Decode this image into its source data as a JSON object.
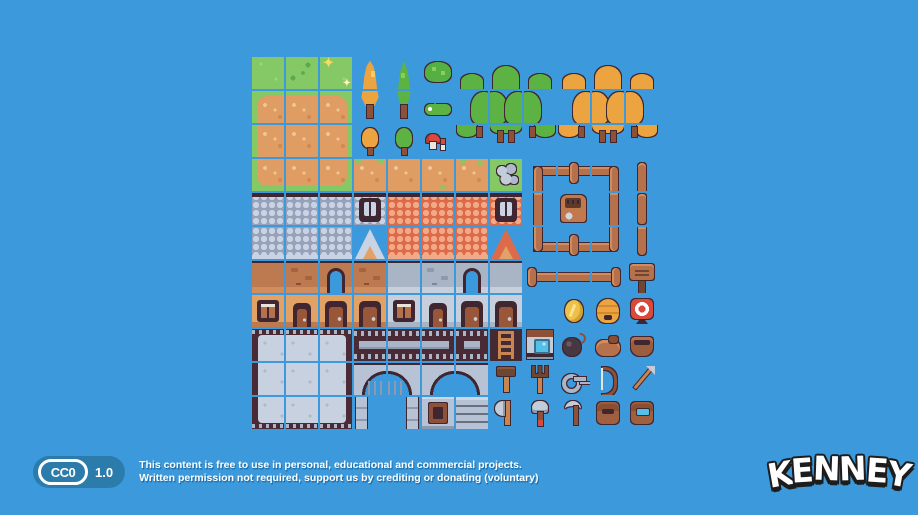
{
  "scene": {
    "background_color": "#3b99dc",
    "description": "Pixel-art RPG town tilesheet preview on blue background"
  },
  "tilesheet": {
    "columns": 12,
    "rows": 11,
    "tile_size": 32,
    "gap": 2,
    "origin_x": 252,
    "origin_y": 57,
    "grid": [
      [
        "grass",
        "grass_dark",
        "grass_sparkle",
        "tree_orange_top",
        "tree_pine_top",
        "bush",
        "fg_tl",
        "fg_tm",
        "fg_tr",
        "fo_tl",
        "fo_tm",
        "fo_tr"
      ],
      [
        "dirt_tl",
        "dirt_t",
        "dirt_tr",
        "tree_orange_bot",
        "tree_pine_bot",
        "caterpillar",
        "fg_ml",
        "fg_mm",
        "fg_mr",
        "fo_ml",
        "fo_mm",
        "fo_mr"
      ],
      [
        "dirt_l",
        "dirt_c",
        "dirt_r",
        "tree_orange_sm",
        "tree_pine_sm",
        "mushrooms",
        "fg_bl",
        "fg_bm",
        "fg_br",
        "fo_bl",
        "fo_bm",
        "fo_br"
      ],
      [
        "dirt_bl",
        "dirt_b",
        "dirt_br",
        "dirt_grass_top",
        "dirt_plain",
        "dirt_tuft",
        "dirt_tufts",
        "stones_grass",
        "fence_tl",
        "fence_tt",
        "fence_tr",
        "post_top"
      ],
      [
        "roof_gray",
        "roof_gray",
        "roof_gray",
        "roof_gray_win",
        "roof_red",
        "roof_red",
        "roof_red",
        "roof_red_win",
        "fence_vl",
        "shed",
        "fence_vr",
        "post_mid"
      ],
      [
        "roof_gray2",
        "roof_gray2",
        "roof_gray2",
        "roof_gray_peak",
        "roof_red2",
        "roof_red2",
        "roof_red2",
        "roof_red_peak",
        "fence_bl",
        "fence_bt",
        "fence_br",
        "post_bot"
      ],
      [
        "wall_tan",
        "wall_tan_br",
        "wall_tan_open",
        "wall_tan_br",
        "wall_gray",
        "wall_gray_br",
        "wall_gray_open",
        "wall_gray",
        "fence_end_l",
        "fence_rail",
        "fence_end_r",
        "sign"
      ],
      [
        "wall_tan_win",
        "wall_tan_door",
        "wall_tan_door2",
        "wall_tan_door2",
        "wall_gray_win",
        "wall_gray_door",
        "wall_gray_door2",
        "wall_gray_door2",
        "",
        "coin",
        "beehive",
        "target"
      ],
      [
        "plat_tl",
        "plat_t",
        "plat_tr",
        "bridge_l",
        "bridge_m",
        "bridge_r",
        "bridge_s",
        "ladder",
        "well",
        "bomb",
        "pouch",
        "basket"
      ],
      [
        "plat_l",
        "plat_c",
        "plat_r",
        "arch1_l",
        "arch1_r",
        "arch2_l",
        "arch2_r",
        "hammer",
        "pitchfork",
        "key",
        "bow",
        "arrow"
      ],
      [
        "plat_bl",
        "plat_b",
        "plat_br",
        "archleg_l",
        "archleg_r",
        "stone_win",
        "stone_brick",
        "axe",
        "sledge",
        "scythe",
        "satchel",
        "satchel_open"
      ]
    ],
    "legend": {
      "grass": "grass tile",
      "grass_dark": "grass with dark tufts",
      "grass_sparkle": "grass with sparkles",
      "tree_orange_top": "tall autumn tree (top)",
      "tree_orange_bot": "tall autumn tree (bottom with trunk)",
      "tree_pine_top": "tall pine tree (top)",
      "tree_pine_bot": "tall pine tree (bottom with trunk)",
      "bush": "round bush",
      "caterpillar": "green caterpillar",
      "mushrooms": "red mushrooms",
      "tree_orange_sm": "small autumn tree",
      "tree_pine_sm": "small pine tree",
      "fg_tl": "green forest top-left",
      "fg_tm": "green forest top-middle",
      "fg_tr": "green forest top-right",
      "fg_ml": "green forest middle-left",
      "fg_mm": "green forest middle",
      "fg_mr": "green forest middle-right",
      "fg_bl": "green forest bottom-left",
      "fg_bm": "green forest bottom trunks",
      "fg_br": "green forest bottom-right",
      "fo_tl": "autumn forest top-left",
      "fo_tm": "autumn forest top-middle",
      "fo_tr": "autumn forest top-right",
      "fo_ml": "autumn forest middle-left",
      "fo_mm": "autumn forest middle",
      "fo_mr": "autumn forest middle-right",
      "fo_bl": "autumn forest bottom-left",
      "fo_bm": "autumn forest bottom trunks",
      "fo_br": "autumn forest bottom-right",
      "dirt_tl": "dirt patch top-left",
      "dirt_t": "dirt patch top",
      "dirt_tr": "dirt patch top-right",
      "dirt_l": "dirt patch left",
      "dirt_c": "dirt patch center",
      "dirt_r": "dirt patch right",
      "dirt_bl": "dirt patch bottom-left",
      "dirt_b": "dirt patch bottom",
      "dirt_br": "dirt patch bottom-right",
      "dirt_grass_top": "dirt with grass edge",
      "dirt_plain": "plain dirt",
      "dirt_tuft": "dirt with tuft",
      "dirt_tufts": "dirt with tufts",
      "stones_grass": "pebbles on grass",
      "roof_gray": "gray shingle roof",
      "roof_gray2": "gray shingle roof eave",
      "roof_gray_win": "gray roof attic window",
      "roof_gray_peak": "gray roof gable peak",
      "roof_red": "red shingle roof",
      "roof_red2": "red shingle roof eave",
      "roof_red_win": "red roof attic window",
      "roof_red_peak": "red roof gable peak",
      "wall_tan": "tan wall",
      "wall_tan_br": "tan wall with bricks",
      "wall_tan_open": "tan wall doorway opening",
      "wall_gray": "gray wall",
      "wall_gray_br": "gray wall with bricks",
      "wall_gray_open": "gray wall doorway opening",
      "wall_tan_win": "tan facade window",
      "wall_tan_door": "tan facade small door",
      "wall_tan_door2": "tan facade large door",
      "wall_gray_win": "gray facade window",
      "wall_gray_door": "gray facade small door",
      "wall_gray_door2": "gray facade large door",
      "fence_tl": "fence corner top-left",
      "fence_tt": "fence top junction",
      "fence_tr": "fence corner top-right",
      "fence_vl": "fence vertical left",
      "fence_vr": "fence vertical right",
      "fence_bl": "fence corner bottom-left",
      "fence_bt": "fence bottom junction",
      "fence_br": "fence corner bottom-right",
      "fence_end_l": "fence end left",
      "fence_rail": "fence rail",
      "fence_end_r": "fence end right",
      "post_top": "wooden post top",
      "post_mid": "wooden post middle",
      "post_bot": "wooden post bottom",
      "sign": "wooden sign",
      "shed": "wooden shed with lock",
      "plat_tl": "stone platform top-left",
      "plat_t": "stone platform top",
      "plat_tr": "stone platform top-right",
      "plat_l": "stone platform left",
      "plat_c": "stone platform center",
      "plat_r": "stone platform right",
      "plat_bl": "stone platform bottom-left",
      "plat_b": "stone platform bottom",
      "plat_br": "stone platform bottom-right",
      "bridge_l": "battlement wall left",
      "bridge_m": "battlement wall middle",
      "bridge_r": "battlement wall right",
      "bridge_s": "battlement wall short",
      "arch1_l": "stone arch with portcullis left",
      "arch1_r": "stone arch with portcullis right",
      "arch2_l": "stone arch left",
      "arch2_r": "stone arch right",
      "archleg_l": "arch column left",
      "archleg_r": "arch column right",
      "stone_win": "stone wall with window",
      "stone_brick": "stone brick wall",
      "ladder": "ladder",
      "well": "well with water",
      "coin": "gold coin",
      "beehive": "beehive",
      "target": "archery target",
      "bomb": "bomb",
      "pouch": "leather pouch",
      "basket": "basket",
      "hammer": "hammer",
      "pitchfork": "pitchfork",
      "key": "key",
      "bow": "bow",
      "arrow": "arrow",
      "axe": "axe",
      "sledge": "sledgehammer",
      "scythe": "scythe",
      "satchel": "closed satchel",
      "satchel_open": "open satchel"
    }
  },
  "footer": {
    "badge": {
      "mark": "CC0",
      "version": "1.0"
    },
    "line1": "This content is free to use in personal, educational and commercial projects.",
    "line2": "Written permission not required, support us by crediting or donating (voluntary)"
  },
  "logo": {
    "text": "KENNEY"
  },
  "palette": {
    "background": "#3b99dc",
    "outline": "#3f2631",
    "badge_blue": "#2b7cab",
    "grass": "#84c965",
    "dirt": "#df9c63",
    "wood": "#b5714b",
    "autumn_tree": "#eba43f",
    "pine_tree": "#5cb344",
    "roof_gray": "#97a2ba",
    "roof_red": "#dd6a48",
    "wall_tan": "#bd7950",
    "wall_gray": "#a9b4c5",
    "stone": "#b7c2d4",
    "gold": "#ecc049",
    "red": "#d94a3d",
    "water": "#52c0e8"
  }
}
